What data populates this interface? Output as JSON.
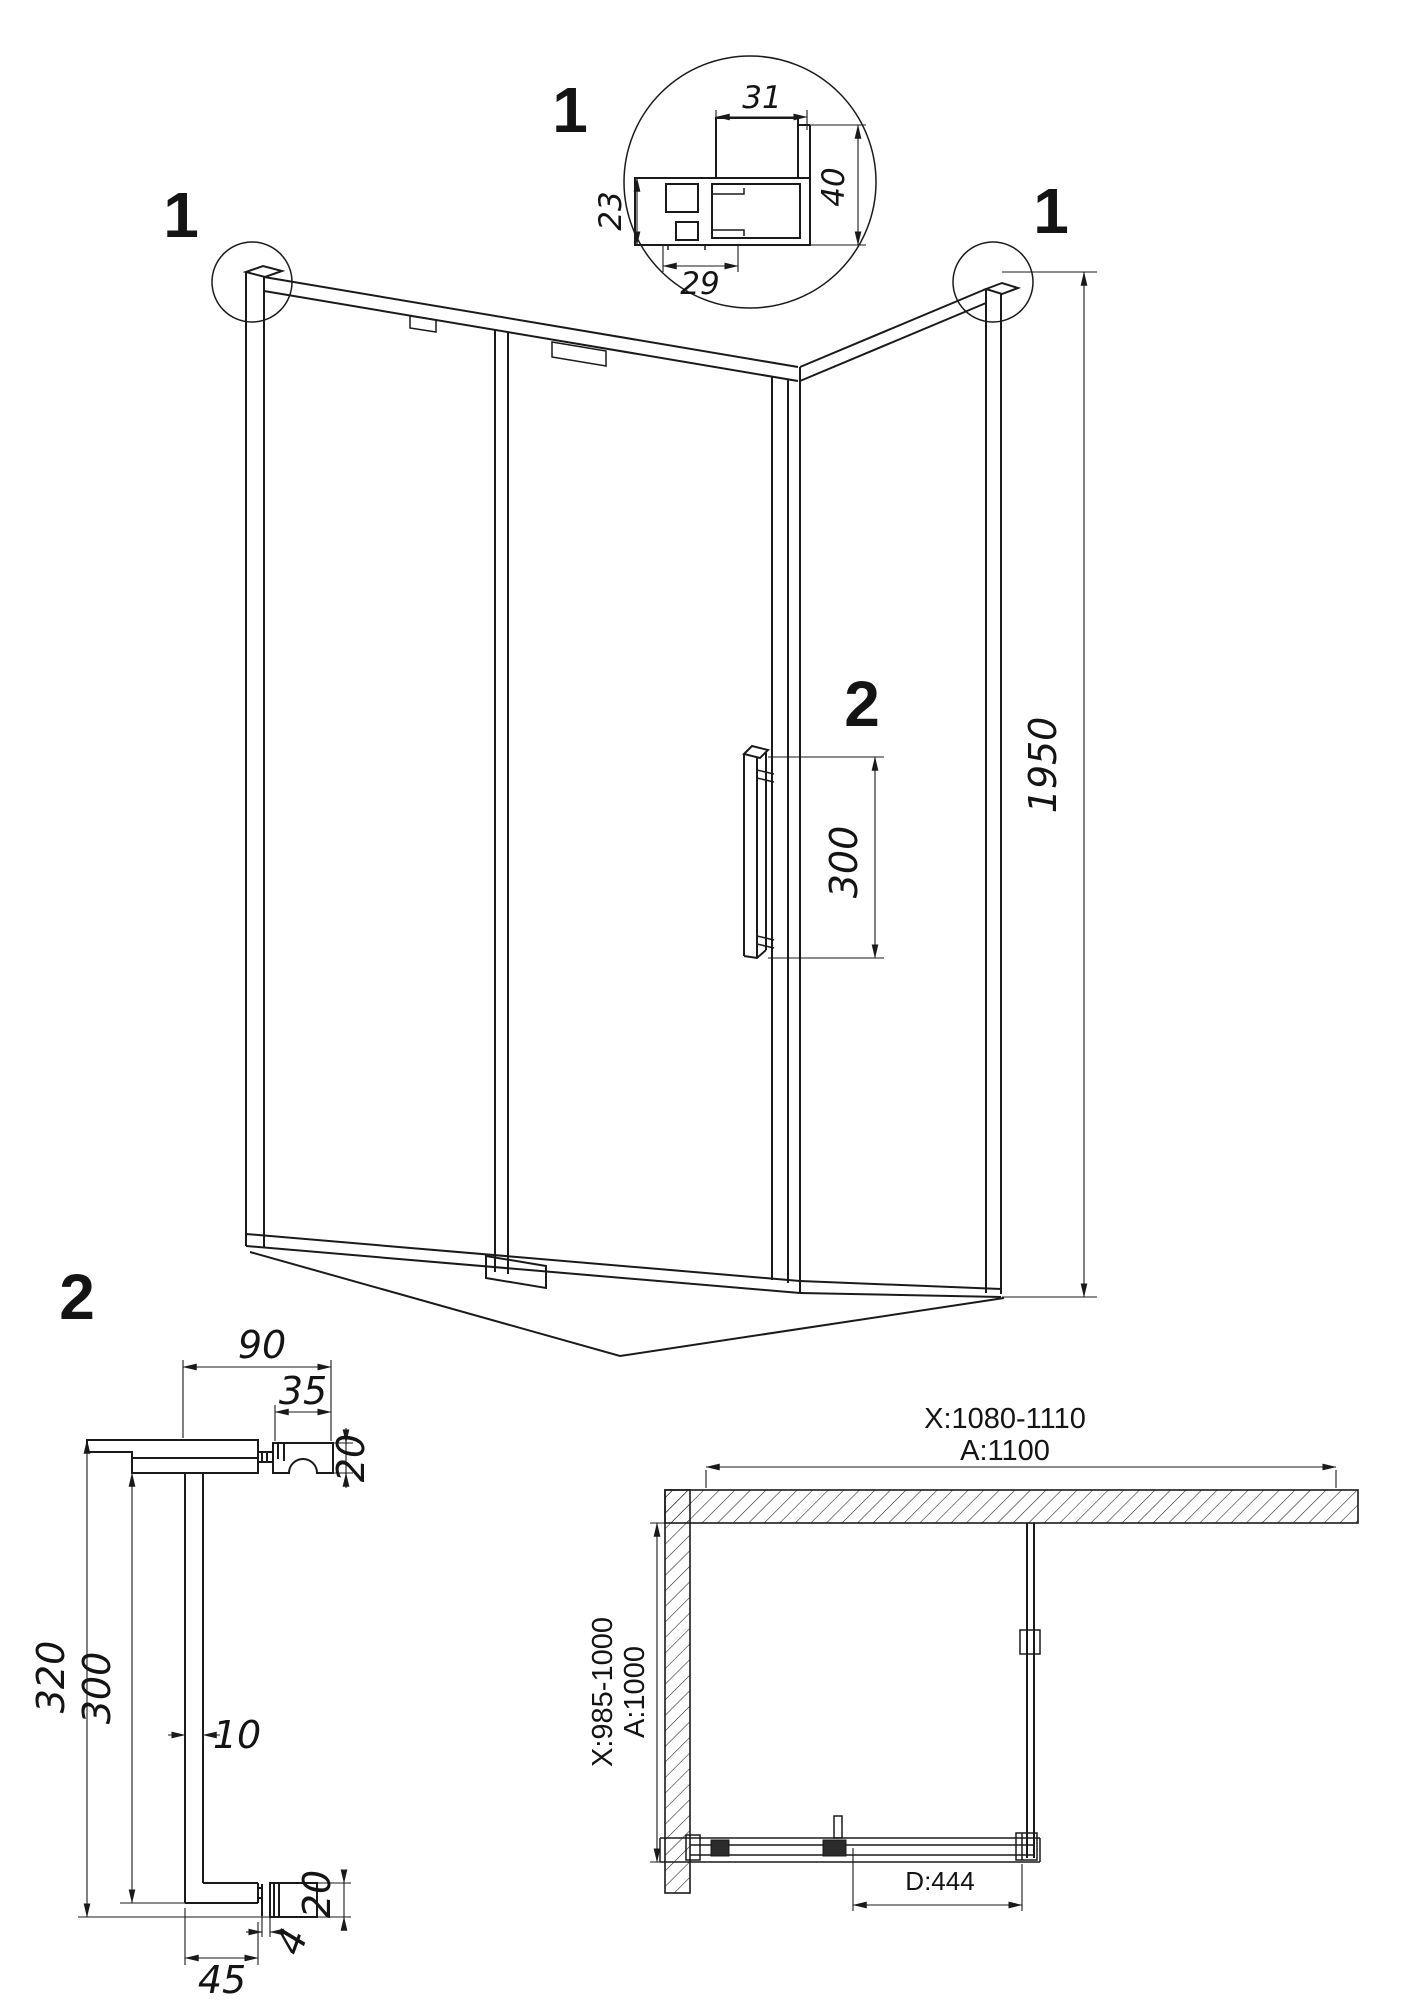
{
  "detail_1": {
    "label": "1",
    "dim_top": "31",
    "dim_left": "23",
    "dim_bottom": "29",
    "dim_right": "40"
  },
  "main_view": {
    "corner_left_label": "1",
    "corner_right_label": "1",
    "height_dim": "1950",
    "handle_callout_label": "2",
    "handle_height_dim": "300"
  },
  "handle_detail": {
    "label": "2",
    "top_width": "90",
    "knob_width": "35",
    "knob_height_top": "20",
    "overall_height": "320",
    "inner_height": "300",
    "bar_thickness": "10",
    "knob_height_bottom": "20",
    "plate_thickness": "4",
    "bottom_width": "45"
  },
  "plan_view": {
    "width_adjust_range": "X:1080-1110",
    "width": "A:1100",
    "depth_adjust_range": "X:985-1000",
    "depth": "A:1000",
    "door_width": "D:444"
  }
}
